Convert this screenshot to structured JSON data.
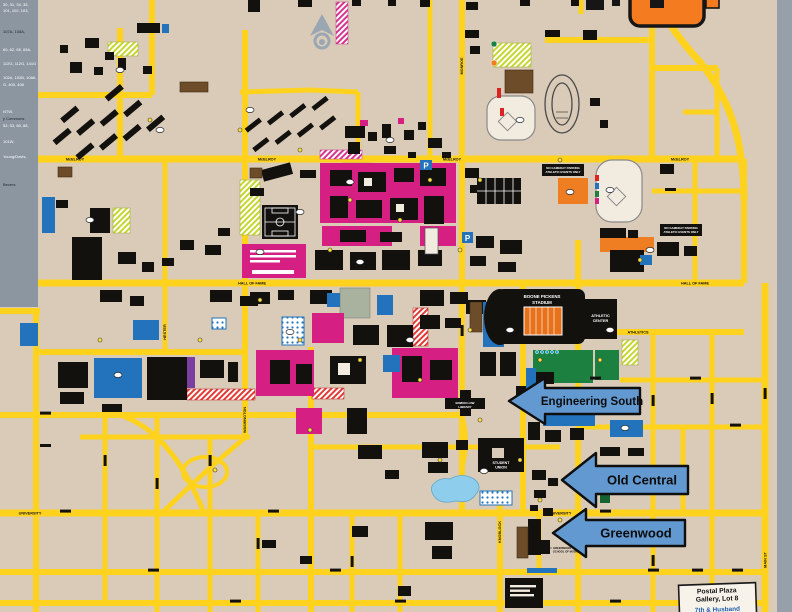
{
  "callouts": {
    "engineering_south": "Engineering South",
    "old_central": "Old Central",
    "greenwood": "Greenwood"
  },
  "postal_plaza": {
    "line1": "Postal Plaza",
    "line2": "Gallery, Lot 8",
    "line3": "7th & Husband"
  },
  "landmarks": {
    "stadium_line1": "BOONE PICKENS",
    "stadium_line2": "STADIUM",
    "athletic_center_line1": "ATHLETIC",
    "athletic_center_line2": "CENTER",
    "student_union_line1": "STUDENT",
    "student_union_line2": "UNION",
    "library_line1": "EDMON LOW",
    "library_line2": "LIBRARY",
    "gameday_line1": "NO GAMEDAY PARKING",
    "gameday_line2": "ATHLETIC EVENTS ONLY",
    "greenwood_school_line1": "GREENWOOD",
    "greenwood_school_line2": "SCHOOL OF MUSIC"
  },
  "streets": {
    "mcelroy": "McELROY",
    "hall_of_fame": "HALL OF FAME",
    "athletics": "ATHLETICS",
    "university": "UNIVERSITY",
    "main_st": "MAIN ST",
    "knoblock": "KNOBLOCK",
    "monroe": "MONROE",
    "duck": "DUCK",
    "hester": "HESTER",
    "washington": "WASHINGTON"
  },
  "legend": {
    "lines": [
      "30, 31, 34, 35,",
      "101, 102, 103,",
      "107A, 108A,",
      "60, 62, 65, 65A,",
      "112G, 112G, 141G",
      "102A, 102B, 108A,",
      "G, 400, 408",
      "NTW,",
      "y Commons",
      "52, 53, 80, 88,",
      "101W,",
      "Young/Davis,",
      "Bevers"
    ]
  },
  "icons": {
    "parking_glyph": "P"
  },
  "colors": {
    "background": "#d9cbb8",
    "road": "#ffd21e",
    "construction_pink": "#d61f82",
    "parking_blue": "#2273bb",
    "arrow_blue": "#6399d1",
    "brand_orange": "#f47b20",
    "legend_gray": "#8b96a1"
  }
}
